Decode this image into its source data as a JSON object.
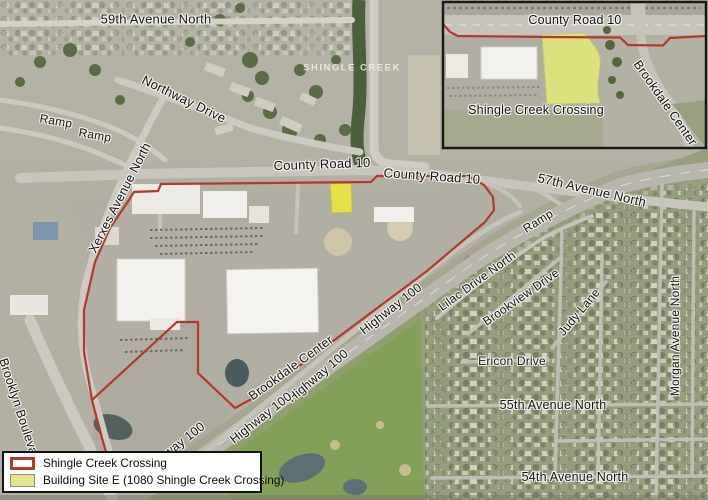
{
  "map": {
    "description": "Aerial map of Shingle Creek Crossing site, Brooklyn Center",
    "street_labels": [
      {
        "id": "59th-avenue-north",
        "text": "59th Avenue North",
        "x": 156,
        "y": 19,
        "rot": 0,
        "size": 13
      },
      {
        "id": "northway-drive",
        "text": "Northway Drive",
        "x": 184,
        "y": 99,
        "rot": 26,
        "size": 13
      },
      {
        "id": "ramp-nw-1",
        "text": "Ramp",
        "x": 56,
        "y": 121,
        "rot": 10,
        "size": 12
      },
      {
        "id": "ramp-nw-2",
        "text": "Ramp",
        "x": 95,
        "y": 135,
        "rot": 10,
        "size": 12
      },
      {
        "id": "xerxes-avenue-north",
        "text": "Xerxes Avenue North",
        "x": 120,
        "y": 198,
        "rot": -63,
        "size": 12.5
      },
      {
        "id": "county-road-10-west",
        "text": "County Road 10",
        "x": 322,
        "y": 164,
        "rot": -2,
        "size": 13
      },
      {
        "id": "county-road-10-east",
        "text": "County Road 10",
        "x": 432,
        "y": 176,
        "rot": 4,
        "size": 13
      },
      {
        "id": "57th-avenue-north",
        "text": "57th Avenue North",
        "x": 592,
        "y": 190,
        "rot": 13,
        "size": 13
      },
      {
        "id": "ramp-east",
        "text": "Ramp",
        "x": 538,
        "y": 221,
        "rot": -32,
        "size": 12
      },
      {
        "id": "brooklyn-boulevard",
        "text": "Brooklyn Boulevard",
        "x": 20,
        "y": 412,
        "rot": 72,
        "size": 12.5
      },
      {
        "id": "brookdale-center",
        "text": "Brookdale Center",
        "x": 291,
        "y": 368,
        "rot": -36,
        "size": 12.5
      },
      {
        "id": "highway-100-1",
        "text": "Highway 100",
        "x": 391,
        "y": 309,
        "rot": -38,
        "size": 12.5
      },
      {
        "id": "highway-100-2",
        "text": "Highway 100",
        "x": 318,
        "y": 376,
        "rot": -40,
        "size": 12.5
      },
      {
        "id": "highway-100-3",
        "text": "Highway 100",
        "x": 261,
        "y": 418,
        "rot": -38,
        "size": 12.5
      },
      {
        "id": "highway-100-4",
        "text": "Highway 100",
        "x": 174,
        "y": 448,
        "rot": -38,
        "size": 12.5
      },
      {
        "id": "lilac-drive-north",
        "text": "Lilac Drive North",
        "x": 477,
        "y": 281,
        "rot": -36,
        "size": 12
      },
      {
        "id": "brookview-drive",
        "text": "Brookview Drive",
        "x": 521,
        "y": 297,
        "rot": -35,
        "size": 12
      },
      {
        "id": "judy-lane",
        "text": "Judy Lane",
        "x": 579,
        "y": 312,
        "rot": -50,
        "size": 12
      },
      {
        "id": "ericon-drive",
        "text": "Ericon Drive",
        "x": 512,
        "y": 361,
        "rot": 0,
        "size": 12
      },
      {
        "id": "55th-avenue-north",
        "text": "55th Avenue North",
        "x": 553,
        "y": 405,
        "rot": 0,
        "size": 12.5
      },
      {
        "id": "54th-avenue-north",
        "text": "54th Avenue North",
        "x": 575,
        "y": 477,
        "rot": 0,
        "size": 12.5
      },
      {
        "id": "morgan-avenue-north",
        "text": "Morgan Avenue North",
        "x": 675,
        "y": 336,
        "rot": -90,
        "size": 12
      },
      {
        "id": "shingle-creek",
        "text": "SHINGLE CREEK",
        "x": 352,
        "y": 68,
        "rot": 0,
        "size": 9.5,
        "variant": "faint"
      }
    ]
  },
  "inset": {
    "labels": [
      {
        "id": "inset-county-road-10",
        "text": "County Road 10",
        "x": 575,
        "y": 20,
        "rot": 0,
        "size": 12.5
      },
      {
        "id": "inset-shingle-creek-crossing",
        "text": "Shingle Creek Crossing",
        "x": 536,
        "y": 110,
        "rot": 0,
        "size": 12.5
      },
      {
        "id": "inset-brookdale-center",
        "text": "Brookdale Center",
        "x": 665,
        "y": 103,
        "rot": 55,
        "size": 12.5
      }
    ]
  },
  "legend": {
    "items": [
      {
        "label": "Shingle Creek Crossing",
        "swatch": "outline"
      },
      {
        "label": "Building Site E (1080 Shingle Creek Crossing)",
        "swatch": "fill"
      }
    ]
  },
  "colors": {
    "boundary": "#b5372e",
    "site_fill_main": "#e9e73f",
    "site_fill_inset": "#dde17c",
    "legend_site_fill": "#e2e58d"
  }
}
